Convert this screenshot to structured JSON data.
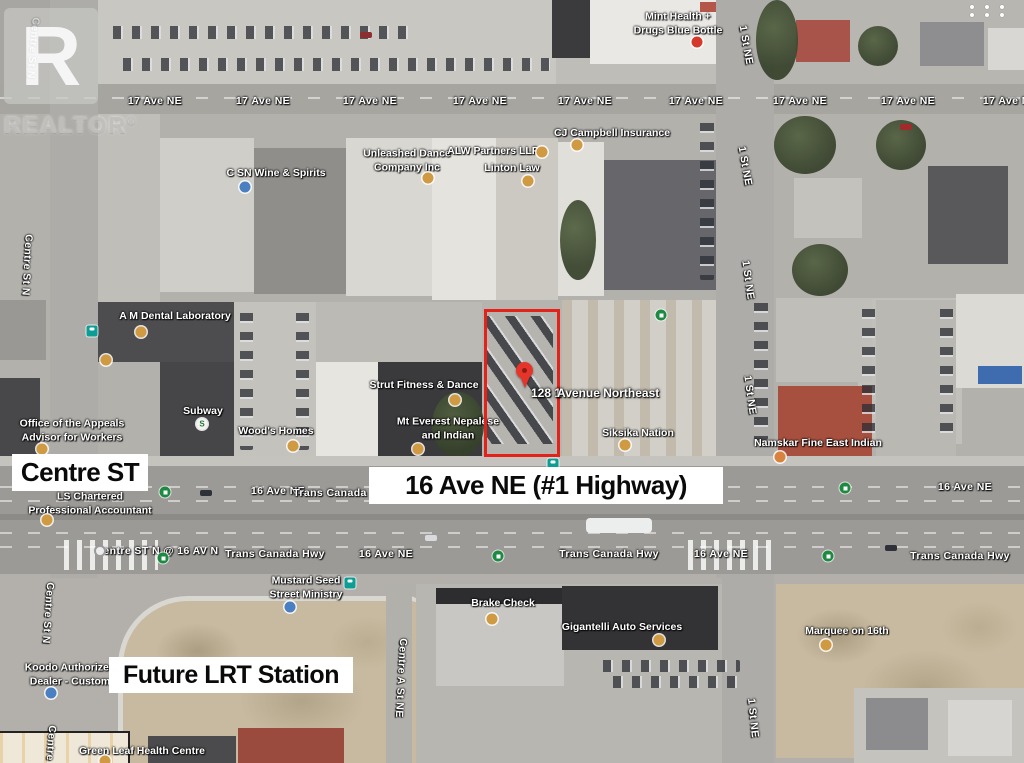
{
  "watermark": {
    "logo_letter": "R",
    "brand": "REALTOR",
    "registered_mark": "®"
  },
  "ui": {
    "apps_grid_icon": "apps-grid",
    "apps_grid_dots": 6
  },
  "overlay_annotations": {
    "centre_st": "Centre ST",
    "highway": "16 Ave NE (#1 Highway)",
    "future_lrt": "Future LRT Station"
  },
  "property": {
    "address_left": "128 1",
    "address_right": "Avenue Northeast",
    "highlight_color": "#e32219",
    "pin_color": "#e5352b"
  },
  "colors": {
    "poi_dot": "#cf9a41",
    "blue_dot": "#4a7fc1",
    "shop_dot": "#d5392b",
    "transit_teal": "#0c9d95",
    "transit_green": "#1d8a41",
    "overlay_text": "#0a0a0a"
  },
  "street_labels": [
    {
      "text": "17 Ave NE",
      "x": 155,
      "y": 101
    },
    {
      "text": "17 Ave NE",
      "x": 263,
      "y": 101
    },
    {
      "text": "17 Ave NE",
      "x": 370,
      "y": 101
    },
    {
      "text": "17 Ave NE",
      "x": 480,
      "y": 101
    },
    {
      "text": "17 Ave NE",
      "x": 585,
      "y": 101
    },
    {
      "text": "17 Ave NE",
      "x": 696,
      "y": 101
    },
    {
      "text": "17 Ave NE",
      "x": 800,
      "y": 101
    },
    {
      "text": "17 Ave NE",
      "x": 908,
      "y": 101
    },
    {
      "text": "17 Ave NE",
      "x": 1010,
      "y": 101
    },
    {
      "text": "16 Ave NE",
      "x": 278,
      "y": 491
    },
    {
      "text": "Trans Canada Hwy",
      "x": 343,
      "y": 493
    },
    {
      "text": "16 Ave NE",
      "x": 965,
      "y": 487
    },
    {
      "text": "Centre ST N @ 16 AV N",
      "x": 157,
      "y": 551
    },
    {
      "text": "Trans Canada Hwy",
      "x": 275,
      "y": 554
    },
    {
      "text": "16 Ave NE",
      "x": 386,
      "y": 554
    },
    {
      "text": "Trans Canada Hwy",
      "x": 609,
      "y": 554
    },
    {
      "text": "16 Ave NE",
      "x": 721,
      "y": 554
    },
    {
      "text": "Trans Canada Hwy",
      "x": 960,
      "y": 556
    },
    {
      "text": "Centre St N",
      "x": 33,
      "y": 48,
      "rot": 95
    },
    {
      "text": "Centre St N",
      "x": 27,
      "y": 265,
      "rot": 93
    },
    {
      "text": "Centre St N",
      "x": 48,
      "y": 613,
      "rot": 94
    },
    {
      "text": "Centre St N",
      "x": 50,
      "y": 756,
      "rot": 94
    },
    {
      "text": "1 St NE",
      "x": 746,
      "y": 45,
      "rot": 80
    },
    {
      "text": "1 St NE",
      "x": 745,
      "y": 166,
      "rot": 80
    },
    {
      "text": "1 St NE",
      "x": 748,
      "y": 280,
      "rot": 82
    },
    {
      "text": "1 St NE",
      "x": 750,
      "y": 395,
      "rot": 82
    },
    {
      "text": "1 St NE",
      "x": 753,
      "y": 718,
      "rot": 84
    },
    {
      "text": "Centre A St NE",
      "x": 401,
      "y": 678,
      "rot": 93
    }
  ],
  "businesses": [
    {
      "lines": [
        "Mint Health +",
        "Drugs Blue Bottle"
      ],
      "x": 678,
      "y": 24,
      "dot": {
        "x": 697,
        "y": 42,
        "type": "shop"
      }
    },
    {
      "lines": [
        "C SN Wine & Spirits"
      ],
      "x": 276,
      "y": 174,
      "dot": {
        "x": 245,
        "y": 187,
        "type": "blue"
      }
    },
    {
      "lines": [
        "Unleashed Dance",
        "Company Inc"
      ],
      "x": 407,
      "y": 161,
      "dot": {
        "x": 428,
        "y": 178,
        "type": "poi"
      }
    },
    {
      "lines": [
        "ALW Partners LLP"
      ],
      "x": 493,
      "y": 152,
      "dot": {
        "x": 542,
        "y": 152,
        "type": "poi"
      }
    },
    {
      "lines": [
        "Linton Law"
      ],
      "x": 512,
      "y": 169,
      "dot": {
        "x": 528,
        "y": 181,
        "type": "poi"
      }
    },
    {
      "lines": [
        "CJ Campbell Insurance"
      ],
      "x": 612,
      "y": 134,
      "dot": {
        "x": 577,
        "y": 145,
        "type": "poi"
      }
    },
    {
      "lines": [
        "A M Dental Laboratory"
      ],
      "x": 175,
      "y": 317,
      "dot": {
        "x": 141,
        "y": 332,
        "type": "poi"
      }
    },
    {
      "lines": [
        "Office of the Appeals",
        "Advisor for Workers"
      ],
      "x": 72,
      "y": 431,
      "dot": {
        "x": 42,
        "y": 449,
        "type": "poi"
      }
    },
    {
      "lines": [
        "Subway"
      ],
      "x": 203,
      "y": 412,
      "dot": {
        "x": 202,
        "y": 424,
        "type": "subway"
      }
    },
    {
      "lines": [
        "Wood's Homes"
      ],
      "x": 276,
      "y": 432,
      "dot": {
        "x": 293,
        "y": 446,
        "type": "poi"
      }
    },
    {
      "lines": [
        "Strut Fitness & Dance"
      ],
      "x": 424,
      "y": 386,
      "dot": {
        "x": 455,
        "y": 400,
        "type": "poi"
      }
    },
    {
      "lines": [
        "Mt Everest Nepalese",
        "and Indian"
      ],
      "x": 448,
      "y": 429,
      "dot": {
        "x": 418,
        "y": 449,
        "type": "poi"
      }
    },
    {
      "lines": [
        "Siksika Nation"
      ],
      "x": 638,
      "y": 434,
      "dot": {
        "x": 625,
        "y": 445,
        "type": "poi"
      }
    },
    {
      "lines": [
        "Namskar Fine East Indian"
      ],
      "x": 818,
      "y": 444,
      "dot": {
        "x": 780,
        "y": 457,
        "type": "food"
      }
    },
    {
      "lines": [
        "LS Chartered",
        "Professional Accountant"
      ],
      "x": 90,
      "y": 504,
      "dot": {
        "x": 47,
        "y": 520,
        "type": "poi"
      }
    },
    {
      "lines": [
        "Mustard Seed",
        "Street Ministry"
      ],
      "x": 306,
      "y": 588,
      "dot": {
        "x": 290,
        "y": 607,
        "type": "blue"
      }
    },
    {
      "lines": [
        "Koodo Authorized",
        "Dealer - Custom"
      ],
      "x": 70,
      "y": 675,
      "dot": {
        "x": 51,
        "y": 693,
        "type": "blue"
      }
    },
    {
      "lines": [
        "Brake Check"
      ],
      "x": 503,
      "y": 604,
      "dot": {
        "x": 492,
        "y": 619,
        "type": "poi"
      }
    },
    {
      "lines": [
        "Gigantelli Auto Services"
      ],
      "x": 622,
      "y": 628,
      "dot": {
        "x": 659,
        "y": 640,
        "type": "poi"
      }
    },
    {
      "lines": [
        "Marquee on 16th"
      ],
      "x": 847,
      "y": 632,
      "dot": {
        "x": 826,
        "y": 645,
        "type": "poi"
      }
    },
    {
      "lines": [
        "Green Leaf Health Centre"
      ],
      "x": 142,
      "y": 752,
      "dot": {
        "x": 105,
        "y": 761,
        "type": "poi"
      }
    }
  ],
  "extra_poi_dots": [
    {
      "x": 106,
      "y": 360,
      "type": "poi"
    }
  ],
  "transit_icons": [
    {
      "x": 92,
      "y": 331,
      "type": "bus-teal"
    },
    {
      "x": 553,
      "y": 464,
      "type": "bus-teal"
    },
    {
      "x": 350,
      "y": 583,
      "type": "bus-teal"
    },
    {
      "x": 661,
      "y": 315,
      "type": "stop-green"
    },
    {
      "x": 165,
      "y": 492,
      "type": "stop-green"
    },
    {
      "x": 163,
      "y": 558,
      "type": "stop-green"
    },
    {
      "x": 498,
      "y": 556,
      "type": "stop-green"
    },
    {
      "x": 828,
      "y": 556,
      "type": "stop-green"
    },
    {
      "x": 845,
      "y": 488,
      "type": "stop-green"
    },
    {
      "x": 100,
      "y": 551,
      "type": "stop-gray"
    }
  ]
}
